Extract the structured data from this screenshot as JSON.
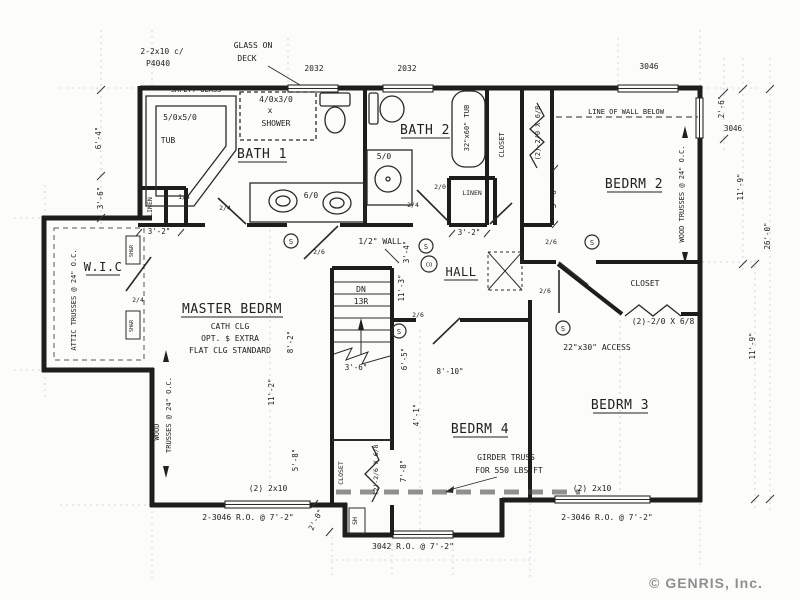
{
  "plan": {
    "rooms": {
      "master": "MASTER BEDRM",
      "bath1": "BATH 1",
      "bath2": "BATH 2",
      "hall": "HALL",
      "wic": "W.I.C",
      "bedrm2": "BEDRM 2",
      "bedrm3": "BEDRM 3",
      "bedrm4": "BEDRM 4"
    },
    "room_notes": {
      "cath": "CATH CLG",
      "opt": "OPT. $ EXTRA",
      "flat": "FLAT CLG STANDARD"
    },
    "fixtures": {
      "safety": "SAFETY GLASS",
      "tub_size": "5/0x5/0",
      "tub": "TUB",
      "shower_size": "4/0x3/0",
      "x": "x",
      "shower": "SHOWER",
      "vanity_bath1": "6/0",
      "vanity_bath2": "5/0",
      "tub2": "32\"x60\" TUB"
    },
    "closets": {
      "linen": "LINEN",
      "closet": "CLOSET",
      "sh": "SH",
      "shr": "SH&R"
    },
    "doors": {
      "d2_6": "2/6",
      "d2_4": "2/4",
      "d2_0": "2/0",
      "d1_4": "1/4",
      "bifold20": "(2)-2/0 X 6/8",
      "bifold26": "(2)-2/6 X 6/8"
    },
    "windows": {
      "w2032": "2032",
      "w3046": "3046",
      "header": "(2) 2x10",
      "header_note1": "2-2x10 c/",
      "header_note2": "P4040",
      "ro3046": "2-3046 R.O. @ 7'-2\"",
      "ro3042": "3042 R.O. @ 7'-2\"",
      "glass1": "GLASS ON",
      "glass2": "DECK"
    },
    "structure": {
      "wood_trusses": "WOOD TRUSSES @ 24\" O.C.",
      "wood": "WOOD",
      "trusses": "TRUSSES @ 24\" O.C.",
      "attic": "ATTIC TRUSSES @ 24\" O.C.",
      "girder1": "GIRDER TRUSS",
      "girder2": "FOR 550 LBS/FT",
      "line_below": "LINE OF WALL BELOW",
      "half_wall": "1/2\" WALL",
      "access": "22\"x30\" ACCESS"
    },
    "stairs": {
      "dn": "DN",
      "risers": "13R"
    },
    "detectors": {
      "smoke": "S",
      "co": "CO"
    },
    "dims": {
      "d2_0": "2'-0\"",
      "d2_6": "2'-6\"",
      "d3_2": "3'-2\"",
      "d3_4": "3'-4\"",
      "d3_6": "3'-6\"",
      "d4_1": "4'-1\"",
      "d5_8": "5'-8\"",
      "d6_4": "6'-4\"",
      "d6_5": "6'-5\"",
      "d7_8": "7'-8\"",
      "d8_2": "8'-2\"",
      "d8_10": "8'-10\"",
      "d11_2": "11'-2\"",
      "d11_3": "11'-3\"",
      "d11_9": "11'-9\"",
      "d26_0": "26'-0\""
    },
    "watermark": "© GENRIS, Inc."
  }
}
